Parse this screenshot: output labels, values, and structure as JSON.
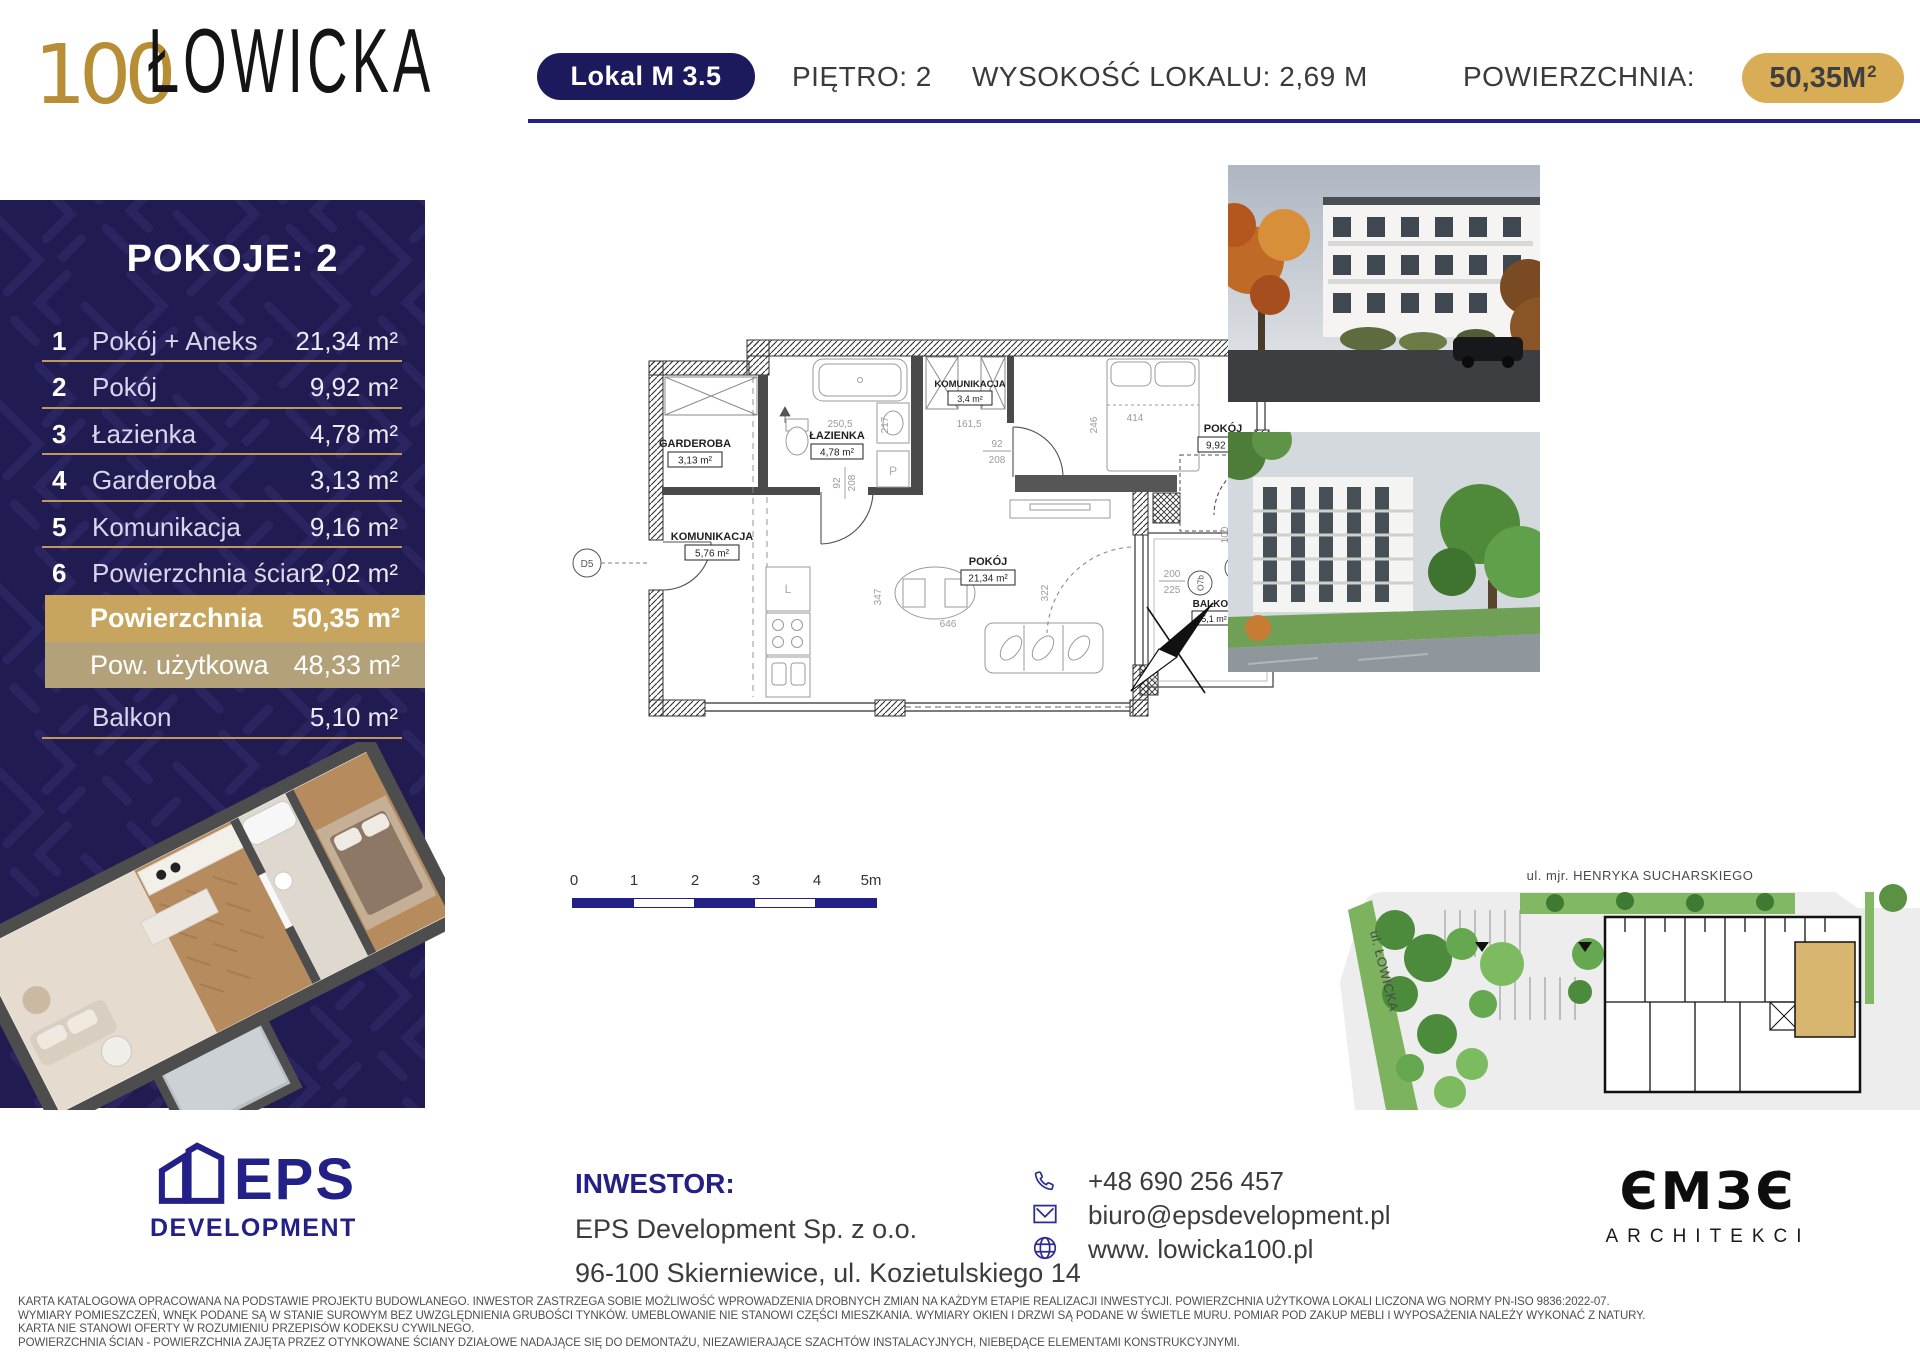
{
  "header": {
    "logo_number": "100",
    "logo_name": "ŁOWICKA",
    "unit_badge": "Lokal M 3.5",
    "floor": "PIĘTRO: 2",
    "height": "WYSOKOŚĆ LOKALU: 2,69 M",
    "area_label": "POWIERZCHNIA:",
    "area_value": "50,35M",
    "area_exp": "2"
  },
  "sidebar": {
    "title": "POKOJE: 2",
    "rooms": [
      {
        "no": "1",
        "name": "Pokój + Aneks",
        "area": "21,34 m²"
      },
      {
        "no": "2",
        "name": "Pokój",
        "area": "9,92 m²"
      },
      {
        "no": "3",
        "name": "Łazienka",
        "area": "4,78 m²"
      },
      {
        "no": "4",
        "name": "Garderoba",
        "area": "3,13 m²"
      },
      {
        "no": "5",
        "name": "Komunikacja",
        "area": "9,16 m²"
      },
      {
        "no": "6",
        "name": "Powierzchnia ścian",
        "area": "2,02 m²"
      }
    ],
    "totals": [
      {
        "label": "Powierzchnia",
        "value": "50,35 m²"
      },
      {
        "label": "Pow. użytkowa",
        "value": "48,33 m²"
      },
      {
        "label": "Balkon",
        "value": "5,10 m²"
      }
    ]
  },
  "floorplan": {
    "labels": {
      "garderoba": {
        "name": "GARDEROBA",
        "area": "3,13 m²"
      },
      "lazienka": {
        "name": "ŁAZIENKA",
        "area": "4,78 m²"
      },
      "komunikacja_mala": {
        "name": "KOMUNIKACJA",
        "area": "3,4 m²"
      },
      "komunikacja": {
        "name": "KOMUNIKACJA",
        "area": "5,76 m²"
      },
      "pokoj_duzy": {
        "name": "POKÓJ",
        "area": "21,34 m²"
      },
      "pokoj_maly": {
        "name": "POKÓJ",
        "area": "9,92 m²"
      },
      "balkon": {
        "name": "BALKON",
        "area": "5,1 m²"
      }
    },
    "dims": {
      "d250": "250,5",
      "d217": "217",
      "d161": "161,5",
      "d414": "414",
      "d246": "246",
      "w92": "92",
      "h208": "208",
      "d347": "347",
      "d322": "322",
      "d646": "646",
      "w200": "200",
      "h225": "225",
      "w100": "100",
      "h225b": "225",
      "hp": "hp 0",
      "o9": "O9",
      "o7b": "O7b",
      "d5": "D5",
      "p": "P",
      "l": "L"
    },
    "scale_ticks": [
      "0",
      "1",
      "2",
      "3",
      "4",
      "5m"
    ]
  },
  "siteplan": {
    "street_top": "ul. mjr. HENRYKA SUCHARSKIEGO",
    "street_left": "ul. ŁOWICKA"
  },
  "footer": {
    "eps_name": "EPS",
    "eps_sub": "DEVELOPMENT",
    "investor_label": "INWESTOR:",
    "investor_name": "EPS Development Sp. z o.o.",
    "investor_address": "96-100 Skierniewice, ul. Kozietulskiego 14",
    "phone": "+48 690 256 457",
    "email": "biuro@epsdevelopment.pl",
    "website": "www. lowicka100.pl",
    "architect_glyphs": "ЄMЗЄ",
    "architect_sub": "ARCHITEKCI"
  },
  "legal": [
    "KARTA KATALOGOWA OPRACOWANA NA PODSTAWIE PROJEKTU BUDOWLANEGO. INWESTOR ZASTRZEGA SOBIE MOŻLIWOŚĆ WPROWADZENIA DROBNYCH ZMIAN NA KAŻDYM ETAPIE REALIZACJI INWESTYCJI. POWIERZCHNIA UŻYTKOWA LOKALI LICZONA WG NORMY PN-ISO 9836:2022-07.",
    "WYMIARY POMIESZCZEŃ, WNĘK PODANE SĄ W STANIE SUROWYM BEZ UWZGLĘDNIENIA GRUBOŚCI TYNKÓW. UMEBLOWANIE NIE STANOWI CZĘŚCI MIESZKANIA. WYMIARY OKIEN I DRZWI SĄ PODANE W ŚWIETLE MURU. POMIAR POD ZAKUP MEBLI I WYPOSAŻENIA NALEŻY WYKONAĆ Z NATURY.",
    "KARTA NIE STANOWI OFERTY W ROZUMIENIU PRZEPISÓW KODEKSU CYWILNEGO.",
    "POWIERZCHNIA ŚCIAN - POWIERZCHNIA ZAJĘTA PRZEZ OTYNKOWANE ŚCIANY DZIAŁOWE NADAJĄCE SIĘ DO DEMONTAŻU, NIEZAWIERAJĄCE SZACHTÓW INSTALACYJNYCH, NIEBĘDĄCE ELEMENTAMI KONSTRUKCYJNYMI."
  ],
  "colors": {
    "navy": "#201c52",
    "navy_accent": "#232087",
    "gold": "#c8a55e",
    "gold_pill": "#d9ad56",
    "tan": "#b2a179",
    "logo_gold": "#b78e35"
  }
}
